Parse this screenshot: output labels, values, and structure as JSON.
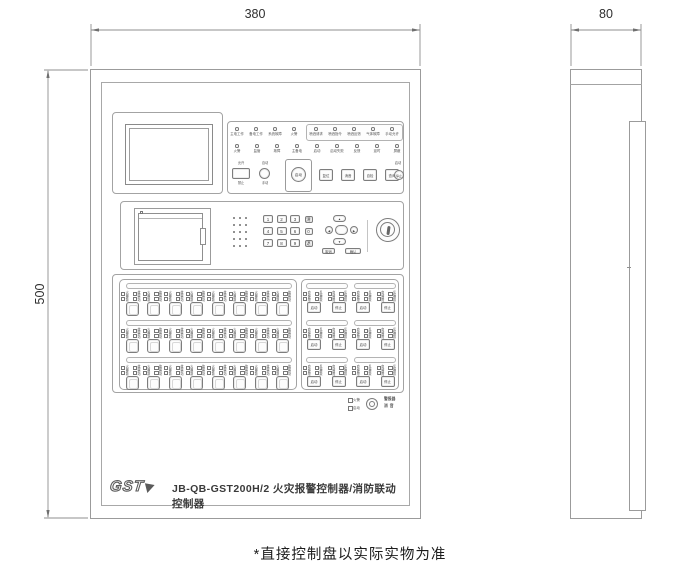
{
  "note": "*直接控制盘以实际实物为准",
  "dimensions": {
    "front_width": "380",
    "front_height": "500",
    "side_depth": "80"
  },
  "branding": {
    "logo": "GST",
    "model_line": "JB-QB-GST200H/2 火灾报警控制器/消防联动控制器"
  },
  "top_indicators": {
    "row1": [
      "主电工作",
      "备电工作",
      "系统故障",
      "火警"
    ],
    "row1_boxed": [
      "喷洒请求",
      "喷洒指令",
      "喷洒反馈",
      "气体故障",
      "手动允许"
    ],
    "row2": [
      "火警",
      "监管",
      "故障",
      "主备电",
      "启动",
      "启动失败",
      "反馈",
      "延时",
      "屏蔽"
    ]
  },
  "function_row": {
    "lock_button": {
      "above": "允许",
      "below": "禁止"
    },
    "round_button1": {
      "above": "自动",
      "below": "手动"
    },
    "start_button": "启动",
    "square_buttons": [
      "复位",
      "消音",
      "自检",
      "查询"
    ],
    "round_button2": {
      "above": "启动",
      "label": "停止"
    }
  },
  "keypad": {
    "keys": [
      [
        "1",
        "2",
        "3",
        "清"
      ],
      [
        "4",
        "5",
        "6",
        "0"
      ],
      [
        "7",
        "8",
        "9",
        "退"
      ]
    ],
    "arrows": {
      "up": "▲",
      "down": "▼",
      "left": "◀",
      "right": "▶"
    },
    "wide_keys": [
      "取消",
      "确认"
    ]
  },
  "zones": {
    "left": {
      "rows": 3,
      "cols": 8,
      "led_labels": [
        [
          "火警",
          "故障"
        ],
        [
          "屏蔽",
          "启动"
        ]
      ]
    },
    "right": {
      "rows": 3,
      "cols": 4,
      "led_labels": [
        [
          "启动",
          "反馈"
        ],
        [
          "故障",
          "屏蔽"
        ]
      ],
      "button_labels": [
        "启动",
        "停止",
        "启动",
        "停止"
      ]
    }
  },
  "sounder": {
    "led_top": "火警",
    "led_bottom": "启动",
    "label_line1": "警报器",
    "label_line2": "消音"
  }
}
